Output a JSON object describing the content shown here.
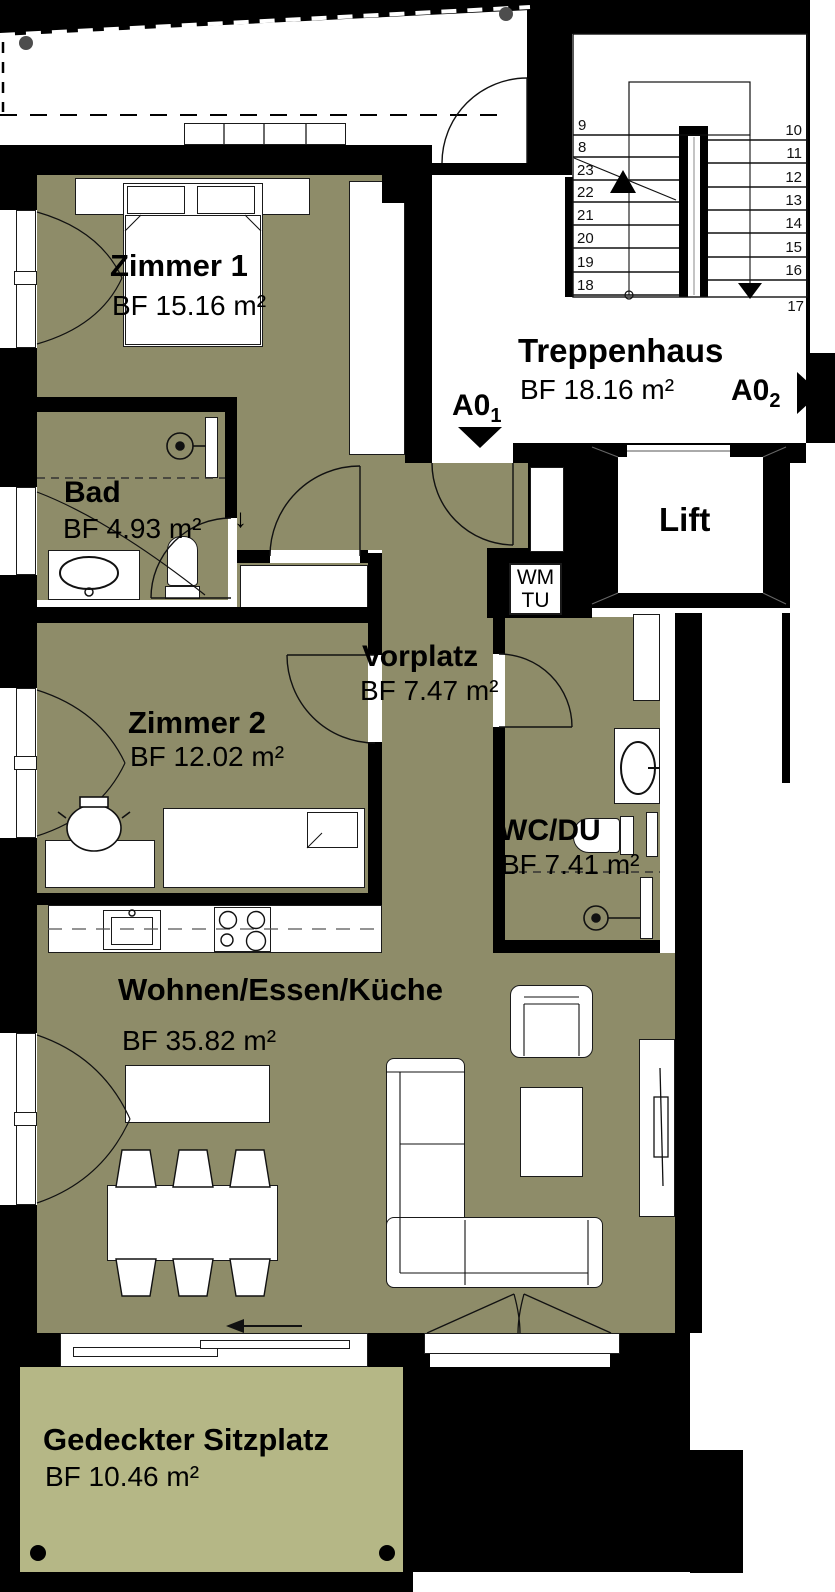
{
  "rooms": {
    "zimmer1": {
      "name": "Zimmer 1",
      "area": "BF 15.16 m²"
    },
    "bad": {
      "name": "Bad",
      "area": "BF 4.93 m²"
    },
    "zimmer2": {
      "name": "Zimmer 2",
      "area": "BF 12.02 m²"
    },
    "vorplatz": {
      "name": "Vorplatz",
      "area": "BF 7.47 m²"
    },
    "wcdu": {
      "name": "WC/DU",
      "area": "BF 7.41 m²"
    },
    "wohnen": {
      "name": "Wohnen/Essen/Küche",
      "area": "BF 35.82 m²"
    },
    "treppenhaus": {
      "name": "Treppenhaus",
      "area": "BF 18.16 m²"
    },
    "sitzplatz": {
      "name": "Gedeckter Sitzplatz",
      "area": "BF 10.46 m²"
    },
    "lift": {
      "name": "Lift"
    }
  },
  "labels": {
    "wm": "WM",
    "tu": "TU",
    "drain_arrow": "↓"
  },
  "markers": {
    "a01": {
      "text": "A0",
      "sub": "1"
    },
    "a02": {
      "text": "A0",
      "sub": "2"
    }
  },
  "stairs": {
    "left": [
      "9",
      "8",
      "23",
      "22",
      "21",
      "20",
      "19",
      "18"
    ],
    "right": [
      "10",
      "11",
      "12",
      "13",
      "14",
      "15",
      "16",
      "17"
    ]
  },
  "colors": {
    "room_fill": "#8E8C69",
    "terrace_fill": "#B5B786",
    "wall": "#000000",
    "column": "#4D4D4D"
  }
}
